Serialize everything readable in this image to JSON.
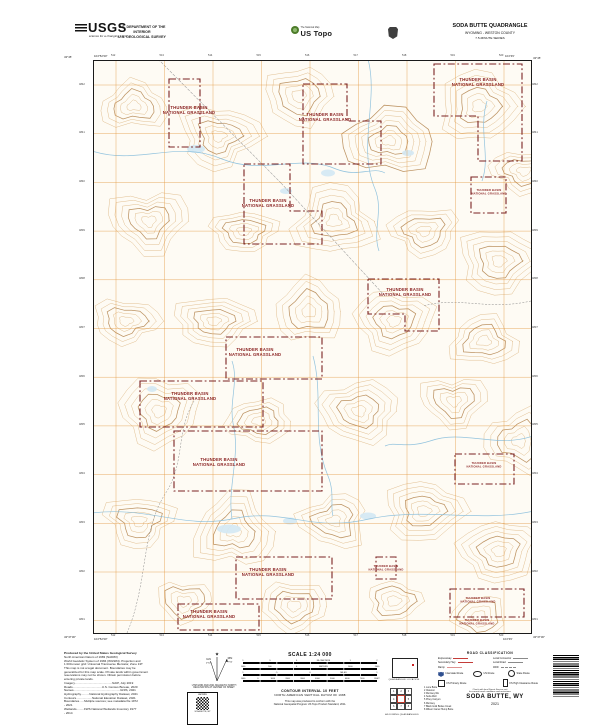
{
  "header": {
    "usgs_logo_text": "USGS",
    "usgs_tagline": "science for a changing world",
    "dept_line1": "U.S. DEPARTMENT OF THE INTERIOR",
    "dept_line2": "U.S. GEOLOGICAL SURVEY",
    "ustopo_small": "The National Map",
    "ustopo_large": "US Topo",
    "quad_title": "SODA BUTTE QUADRANGLE",
    "quad_state_county": "WYOMING - WESTON COUNTY",
    "quad_series": "7.5-MINUTE SERIES"
  },
  "map": {
    "corner_coords": {
      "tl_lat": "43°45'",
      "tl_lon": "104°52'30\"",
      "tr_lat": "43°45'",
      "tr_lon": "104°45'",
      "bl_lat": "43°37'30\"",
      "bl_lon": "104°52'30\"",
      "br_lat": "43°37'30\"",
      "br_lon": "104°45'"
    },
    "top_numbers": [
      "512",
      "513",
      "514",
      "515",
      "516",
      "517",
      "518",
      "519",
      "520"
    ],
    "side_numbers": [
      "4842",
      "4841",
      "4840",
      "4839",
      "4838",
      "4837",
      "4836",
      "4835",
      "4834",
      "4833",
      "4832",
      "4831"
    ],
    "grassland_name": [
      "THUNDER BASIN",
      "NATIONAL GRASSLAND"
    ],
    "labels": [
      {
        "x": 95,
        "y": 48
      },
      {
        "x": 231,
        "y": 55
      },
      {
        "x": 174,
        "y": 141
      },
      {
        "x": 384,
        "y": 20
      },
      {
        "x": 395,
        "y": 130,
        "small": true
      },
      {
        "x": 311,
        "y": 230
      },
      {
        "x": 161,
        "y": 290
      },
      {
        "x": 96,
        "y": 334
      },
      {
        "x": 125,
        "y": 400
      },
      {
        "x": 390,
        "y": 403,
        "small": true
      },
      {
        "x": 174,
        "y": 510
      },
      {
        "x": 292,
        "y": 506,
        "small": true
      },
      {
        "x": 115,
        "y": 552
      },
      {
        "x": 384,
        "y": 538,
        "small": true
      },
      {
        "x": 383,
        "y": 560,
        "small": true
      }
    ],
    "boundaries": [
      "75,18 106,18 106,86 75,86",
      "209,23 253,23 253,60 287,60 287,103 209,103",
      "150,103 196,103 196,150 228,150 228,183 150,183",
      "340,3 428,3 428,100 384,100 384,55 340,55",
      "377,116 412,116 412,152 377,152",
      "274,218 345,218 345,270 311,270 311,253 274,253",
      "132,276 228,276 228,318 132,318",
      "46,320 169,320 169,366 46,366",
      "80,370 228,370 228,430 80,430",
      "361,393 420,393 420,423 361,423",
      "142,496 238,496 238,538 142,538",
      "282,496 302,496 302,518 282,518",
      "84,543 165,543 165,569 84,569",
      "356,528 430,528 430,556 356,556"
    ]
  },
  "footer": {
    "credits": [
      "Produced by the United States Geological Survey",
      "North American Datum of 1983 (NAD83)",
      "World Geodetic System of 1984 (WGS84).  Projection and",
      "1 000-meter grid: Universal Transverse Mercator, Zone 13T",
      "This map is not a legal document. Boundaries may be",
      "generalized for this map scale. Private lands within government",
      "reservations may not be shown. Obtain permission before",
      "entering private lands.",
      "Imagery.............................................NAIP, July 2019",
      "Roads...................................U.S. Census Bureau, 2020",
      "Names........................................................GNIS, 2021",
      "Hydrography..........National Hydrography Dataset, 2021",
      "Contours...................National Elevation Dataset, 2021",
      "Boundaries......Multiple sources; see metadata file 1972",
      "- 2021",
      "Wetlands.........FWS National Wetlands Inventory 1977",
      "- 2014"
    ],
    "declination": {
      "gn": "GN",
      "mn": "MN",
      "gn_value": "0°54'",
      "mn_value": "7°52'",
      "caption1": "UTM GRID AND 2021 MAGNETIC NORTH",
      "caption2": "DECLINATION AT CENTER OF SHEET"
    },
    "qr_box": {
      "top": "US TOPO",
      "bottom": "SODA BUTTE, WY"
    },
    "scale": {
      "title": "SCALE 1:24 000",
      "bars": [
        {
          "ticks": [
            "1",
            ".5",
            "0",
            "KILOMETERS",
            "1",
            "2"
          ]
        },
        {
          "ticks": [
            "1000",
            "500",
            "0",
            "METERS",
            "1000",
            "2000"
          ]
        },
        {
          "ticks": [
            "1",
            ".5",
            "0",
            "MILES",
            "1"
          ]
        },
        {
          "ticks": [
            "1000",
            "0",
            "1000",
            "2000",
            "3000",
            "4000",
            "5000",
            "6000",
            "7000",
            "FEET"
          ]
        }
      ],
      "contour1": "CONTOUR INTERVAL 10 FEET",
      "contour2": "NORTH AMERICAN VERTICAL DATUM OF 1988",
      "conform1": "This map was produced to conform with the",
      "conform2": "National Geospatial Program US Topo Product Standard, 2011."
    },
    "location": {
      "caption": "QUADRANGLE LOCATION"
    },
    "adjoining": {
      "caption": "ADJOINING QUADRANGLES",
      "names": [
        "Lone Butte",
        "Clareton",
        "Morrisey NE",
        "Soda Well",
        "Piney Canyon",
        "Morrisey",
        "Black Gold Buttes Creek",
        "Wilson Camel Hump Butte"
      ]
    },
    "roads": {
      "title": "ROAD CLASSIFICATION",
      "rows": [
        {
          "label": "Expressway",
          "style": "expressway"
        },
        {
          "label": "Local Connector",
          "style": "local"
        },
        {
          "label": "Secondary Hwy",
          "style": "secondary"
        },
        {
          "label": "Local Road",
          "style": "local"
        },
        {
          "label": "Ramp",
          "style": "ramp"
        },
        {
          "label": "4WD",
          "style": "fourwd"
        }
      ],
      "shields": [
        {
          "label": "Interstate Route",
          "type": "interstate"
        },
        {
          "label": "US Route",
          "type": "us"
        },
        {
          "label": "State Route",
          "type": "state"
        }
      ],
      "fs_rows": [
        {
          "label": "FS Primary Route",
          "type": "fsp"
        },
        {
          "label": "FS High Clearance Route",
          "type": "fsh"
        }
      ],
      "note1": "Check with local Forest Service unit",
      "note2": "for current travel conditions and restrictions"
    },
    "map_title": "SODA BUTTE, WY",
    "map_year": "2021"
  },
  "colors": {
    "contour": "#d7ac72",
    "contour_index": "#b1814a",
    "water": "#8cc0dc",
    "utm_grid": "#e2973f",
    "grassland_boundary": "#7a2222",
    "grassland_text": "#8b2323"
  }
}
